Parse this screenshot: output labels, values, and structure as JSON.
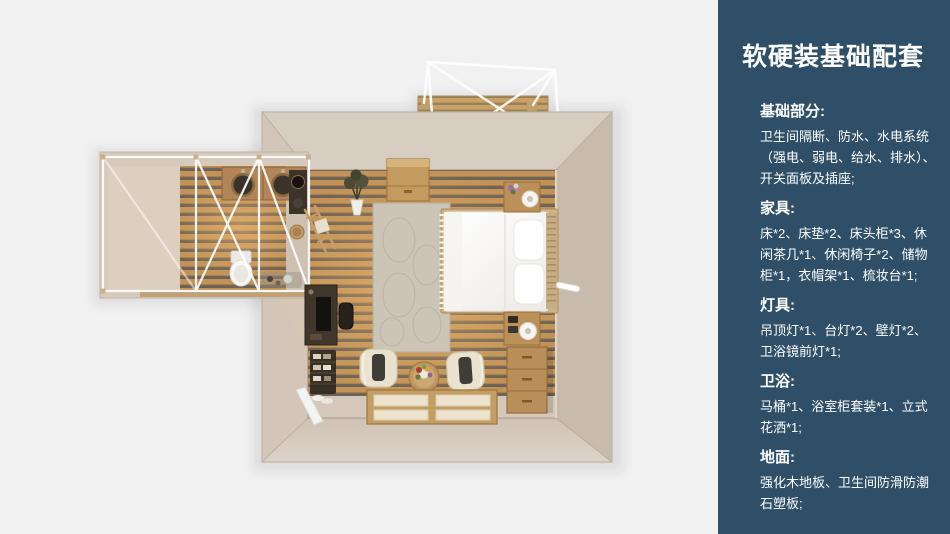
{
  "page": {
    "background_color": "#f1f1f2"
  },
  "sidebar": {
    "background_color": "#2f4f68",
    "text_color": "#ffffff",
    "title": "软硬装基础配套",
    "sections": [
      {
        "heading": "基础部分:",
        "body": "卫生间隔断、防水、水电系统\n（强电、弱电、给水、排水）、\n开关面板及插座;"
      },
      {
        "heading": "家具:",
        "body": "床*2、床垫*2、床头柜*3、休\n闲茶几*1、休闲椅子*2、储物\n柜*1，衣帽架*1、梳妆台*1;"
      },
      {
        "heading": "灯具:",
        "body": "吊顶灯*1、台灯*2、壁灯*2、\n卫浴镜前灯*1;"
      },
      {
        "heading": "卫浴:",
        "body": "马桶*1、浴室柜套装*1、立式\n花洒*1;"
      },
      {
        "heading": "地面:",
        "body": "强化木地板、卫生间防滑防潮\n石塑板;"
      }
    ]
  },
  "floorplan": {
    "type": "3d-top-down-bedroom-suite-render",
    "floor_wood_color": "#c29257",
    "wall_color": "#d5c9bc",
    "frame_color": "#ffffff"
  }
}
